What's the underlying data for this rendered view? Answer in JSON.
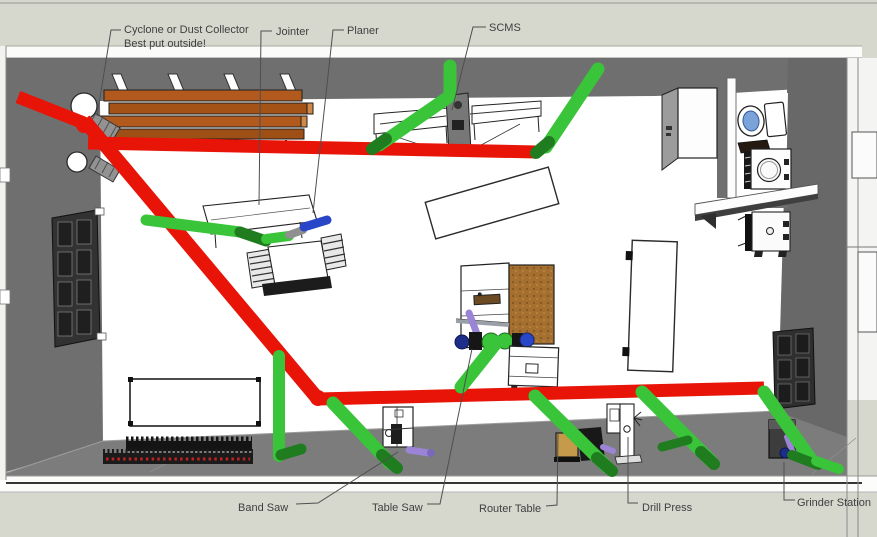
{
  "callouts": {
    "cyclone": {
      "line1": "Cyclone or Dust Collector",
      "line2": "Best put outside!"
    },
    "jointer": "Jointer",
    "planer": "Planer",
    "scms": "SCMS",
    "band_saw": "Band Saw",
    "table_saw": "Table Saw",
    "router_table": "Router Table",
    "drill_press": "Drill Press",
    "grinder_station": "Grinder Station"
  },
  "colors": {
    "main_duct": "#e81408",
    "drop_hose": "#3ac43a",
    "drop_hose_dark": "#1f7d1f",
    "wall": "#6f6f6f",
    "floor_band": "#7c7c7c",
    "outside": "#d6d8ce",
    "lumber": "#b25a1d",
    "fitting_blue": "#2a46c8",
    "fitting_purple": "#9b84d6",
    "toilet_water": "#7aa3d9"
  }
}
